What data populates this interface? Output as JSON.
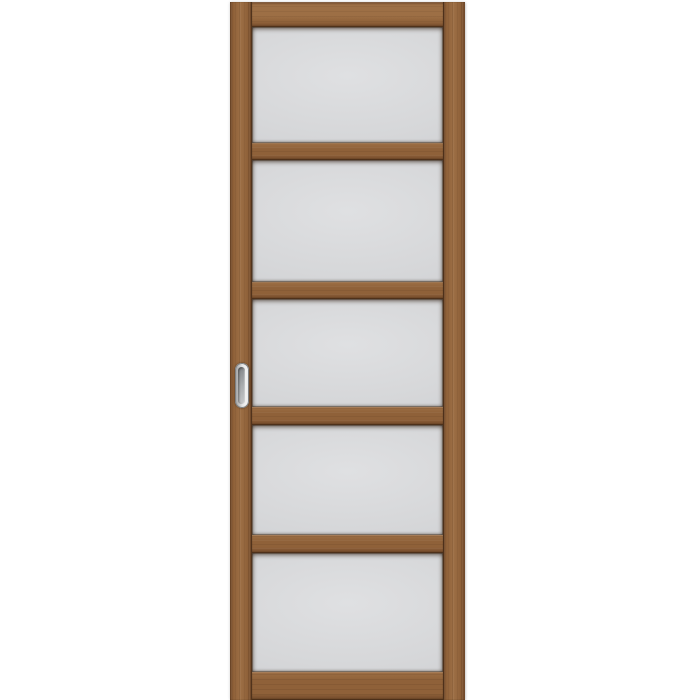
{
  "scene": {
    "description": "Product photograph on a white background of a tall narrow sliding interior door leaf: a walnut-brown wooden frame holding five frosted matte glass panels stacked vertically, separated by wooden cross rails, with a recessed oval chrome pull handle on the left stile at mid-height.",
    "background_color": "#ffffff"
  },
  "door": {
    "panel_count": 5,
    "colors": {
      "wood_base": "#8f6139",
      "wood_light": "#9d6f45",
      "wood_dark": "#6d4628",
      "glass_light": "#dfe0e2",
      "glass_base": "#d6d7d9",
      "glass_dark": "#cdced1"
    },
    "geometry": {
      "left": 230,
      "top": 2,
      "width": 235,
      "height": 698,
      "stile_width": 22
    },
    "sections": [
      {
        "type": "rail",
        "name": "top-rail",
        "top": 0,
        "height": 25
      },
      {
        "type": "panel",
        "name": "glass-panel-1",
        "top": 25,
        "height": 116
      },
      {
        "type": "rail",
        "name": "rail-1",
        "top": 141,
        "height": 17
      },
      {
        "type": "panel",
        "name": "glass-panel-2",
        "top": 158,
        "height": 122
      },
      {
        "type": "rail",
        "name": "rail-2",
        "top": 280,
        "height": 17
      },
      {
        "type": "panel",
        "name": "glass-panel-3",
        "top": 297,
        "height": 108
      },
      {
        "type": "rail",
        "name": "rail-3",
        "top": 405,
        "height": 18
      },
      {
        "type": "panel",
        "name": "glass-panel-4",
        "top": 423,
        "height": 110
      },
      {
        "type": "rail",
        "name": "rail-4",
        "top": 533,
        "height": 18
      },
      {
        "type": "panel",
        "name": "glass-panel-5",
        "top": 551,
        "height": 119
      },
      {
        "type": "rail",
        "name": "bottom-rail",
        "top": 670,
        "height": 28
      }
    ]
  },
  "handle": {
    "kind": "recessed-oval-pull",
    "finish": "chrome-satin",
    "colors": {
      "rim_light": "#e6e7e8",
      "rim_dark": "#9a9b9d",
      "recess_dark": "#85888b",
      "recess_light": "#c3c5c7",
      "outline": "#7e8082"
    },
    "geometry": {
      "left": 5,
      "top": 361,
      "width": 14,
      "height": 45
    }
  }
}
